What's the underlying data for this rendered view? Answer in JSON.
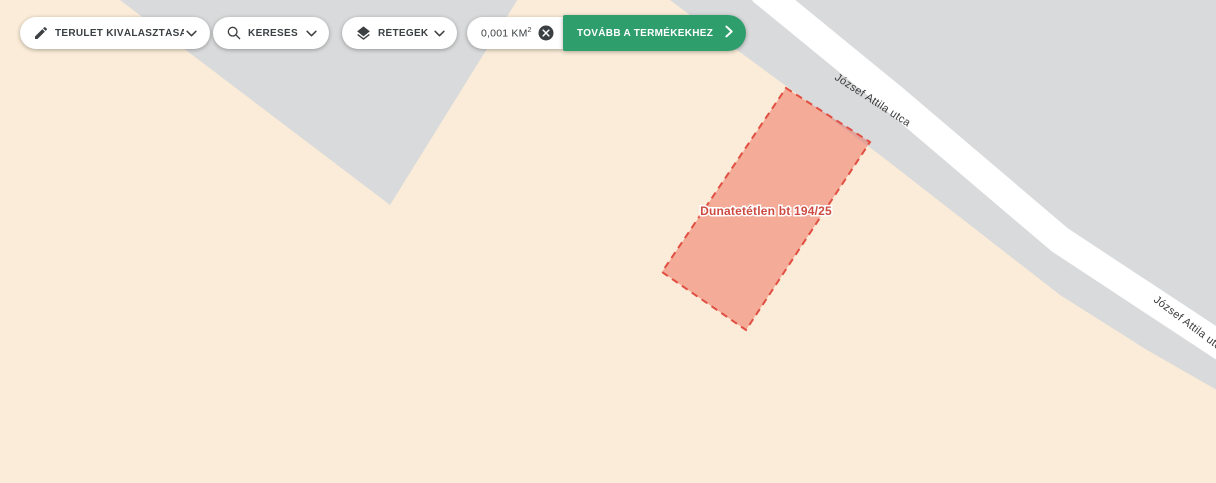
{
  "toolbar": {
    "area_select": {
      "label": "TERÜLET KIVÁLASZTÁSA"
    },
    "search": {
      "label": "KERESÉS"
    },
    "layers": {
      "label": "RÉTEGEK"
    },
    "area": {
      "value": "0,001 KM",
      "sup": "2"
    },
    "proceed": {
      "label": "TOVÁBB A TERMÉKEKHEZ"
    }
  },
  "map": {
    "parcel": {
      "label": "Dunatetétlen bt 194/25"
    },
    "roads": {
      "upper_label": "József Attila utca",
      "lower_label": "József Attila utca"
    }
  },
  "colors": {
    "accent_green": "#2F9E6D",
    "map_background": "#FAECD8",
    "map_block_gray": "#D9DADB",
    "road_white": "#FFFFFF",
    "parcel_fill": "#EE6452",
    "parcel_border": "#E04F42",
    "parcel_label": "#CE4A41",
    "toolbar_text": "#3C4043",
    "road_label": "#3A3A3A"
  }
}
